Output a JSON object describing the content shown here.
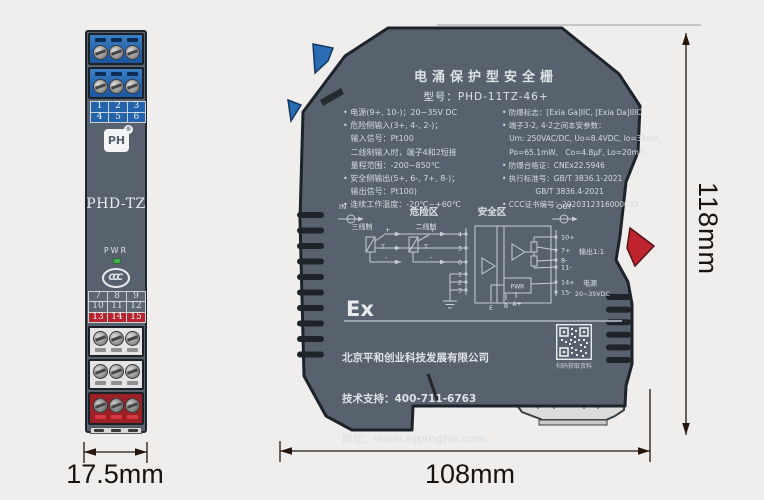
{
  "front_view": {
    "logo_text": "PH",
    "logo_reg": "®",
    "model": "PHD-TZ",
    "pwr_label": "PWR",
    "ccc_mark": "CCC",
    "grid_top": [
      [
        "1",
        "2",
        "3"
      ],
      [
        "4",
        "5",
        "6"
      ]
    ],
    "grid_bottom": [
      [
        "7",
        "8",
        "9"
      ],
      [
        "10",
        "11",
        "12"
      ],
      [
        "13",
        "14",
        "15"
      ]
    ],
    "width_dim": "17.5mm"
  },
  "side_view": {
    "title": "电涌保护型安全栅",
    "model_line": "型号：PHD-11TZ-46+",
    "specs_left": [
      "• 电源(9+, 10-)；20~35V DC",
      "• 危险侧输入(3+, 4-, 2-)；",
      "   输入信号：Pt100",
      "   二线制输入时，端子4和2短接",
      "   量程范围：-200~850℃",
      "• 安全侧输出(5+, 6-, 7+, 8-)；",
      "   输出信号：Pt100)",
      "• 连续工作温度：-20℃~+60℃"
    ],
    "specs_right": [
      "• 防爆标志：[Exia Ga]IIC, [Exia Da]IIIC",
      "• 端子3-2, 4-2之间本安参数：",
      "   Um: 250VAC/DC, Uo=8.4VDC, Io=31mA,",
      "   Po=65.1mW,   Co=4.8μF, Lo=20mH.",
      "• 防爆合格证：CNEx22.5946",
      "• 执行标准号：GB/T 3836.1-2021",
      "              GB/T 3836.4-2021",
      "• CCC证书编号：2020312316000033"
    ],
    "circuit": {
      "in_label": "IN",
      "out_label": "OUT",
      "hazardous_zone": "危险区",
      "safe_zone": "安全区",
      "three_wire_label": "三线制",
      "two_wire_label": "二线制",
      "sensor_label": "T",
      "polarity_plus": "+",
      "polarity_minus": "-",
      "bus_terminals": [
        "4",
        "3",
        "6",
        "1",
        "2",
        "3"
      ],
      "out_terminals": [
        "10+",
        "7+",
        "8-",
        "11-",
        "14+",
        "15-"
      ],
      "output_label": "输出1:1",
      "power_label": "电源",
      "power_range": "20~35VDC",
      "pwr_box_label": "PWR",
      "ground_terminals": [
        "E",
        "B",
        "A+"
      ]
    },
    "ex_mark": "Ex",
    "footer": {
      "company": "北京平和创业科技发展有限公司",
      "support": "技术支持：400-711-6763",
      "website": "网址：www.bjpinghe.com",
      "qr_caption": "扫码获取资料"
    },
    "width_dim": "108mm",
    "height_dim": "118mm"
  },
  "colors": {
    "background": "#efeeec",
    "device_body": "#57626e",
    "terminal_blue": "#2565ae",
    "terminal_red": "#9c2127",
    "red_row": "#b6242c",
    "clip_red": "#c0242e",
    "device_text": "#dde2e6",
    "led_green": "#41b04c",
    "dimension_ink": "#191310"
  }
}
